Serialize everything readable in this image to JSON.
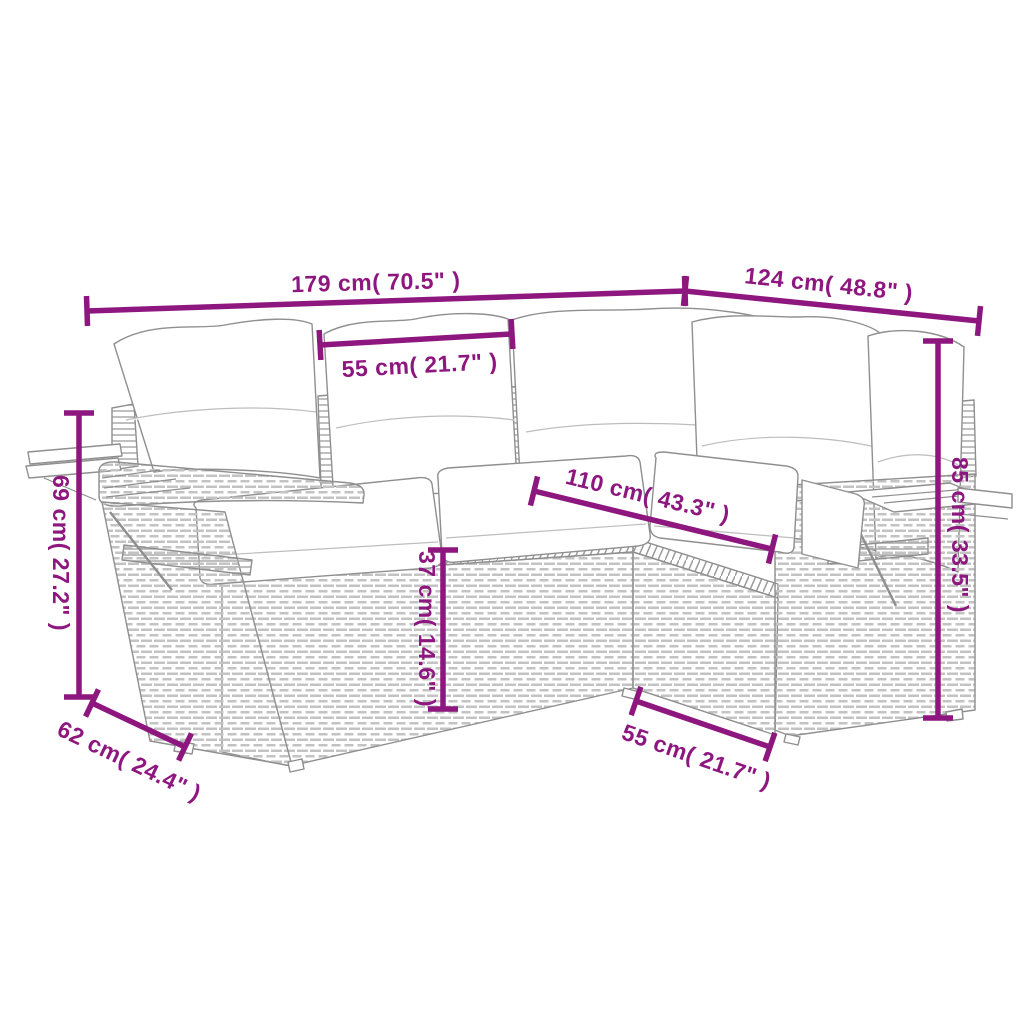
{
  "canvas": {
    "width": 1024,
    "height": 1024,
    "background": "#ffffff"
  },
  "style": {
    "accent_color": "#8E177F",
    "art_line_color": "#8f8f8f",
    "wicker_color": "#c3c3c3",
    "dimension_line_width": 5.5,
    "tick_half_length": 15
  },
  "diagram": {
    "kind": "furniture-dimension-diagram",
    "dimensions": [
      {
        "id": "overall-width-left",
        "label": "179 cm( 70.5\" )",
        "x1": 87,
        "y1": 311,
        "x2": 685,
        "y2": 291,
        "lx": 376,
        "ly": 290,
        "lr": -1.5
      },
      {
        "id": "overall-width-right",
        "label": "124 cm( 48.8\" )",
        "x1": 685,
        "y1": 291,
        "x2": 979,
        "y2": 321,
        "lx": 828,
        "ly": 292,
        "lr": 6
      },
      {
        "id": "seat-width-top",
        "label": "55 cm( 21.7\" )",
        "x1": 320,
        "y1": 345,
        "x2": 512,
        "y2": 334,
        "lx": 420,
        "ly": 373,
        "lr": -3
      },
      {
        "id": "inner-length",
        "label": "110 cm( 43.3\" )",
        "x1": 534,
        "y1": 491,
        "x2": 772,
        "y2": 549,
        "lx": 646,
        "ly": 503,
        "lr": 13.5
      },
      {
        "id": "armrest-height",
        "label": "69 cm( 27.2\" )",
        "x1": 79,
        "y1": 413,
        "x2": 79,
        "y2": 697,
        "lx": 53,
        "ly": 553,
        "lr": 90
      },
      {
        "id": "seat-height",
        "label": "37 cm( 14.6\" )",
        "x1": 443,
        "y1": 550,
        "x2": 443,
        "y2": 709,
        "lx": 419,
        "ly": 629,
        "lr": 90
      },
      {
        "id": "back-height",
        "label": "85 cm( 33.5\" )",
        "x1": 938,
        "y1": 341,
        "x2": 938,
        "y2": 718,
        "lx": 952,
        "ly": 535,
        "lr": 90
      },
      {
        "id": "depth-left",
        "label": "62 cm( 24.4\" )",
        "x1": 92,
        "y1": 703,
        "x2": 185,
        "y2": 747,
        "lx": 126,
        "ly": 768,
        "lr": 25.5
      },
      {
        "id": "seat-width-bottom",
        "label": "55 cm( 21.7\" )",
        "x1": 636,
        "y1": 701,
        "x2": 770,
        "y2": 747,
        "lx": 694,
        "ly": 764,
        "lr": 19
      }
    ]
  }
}
